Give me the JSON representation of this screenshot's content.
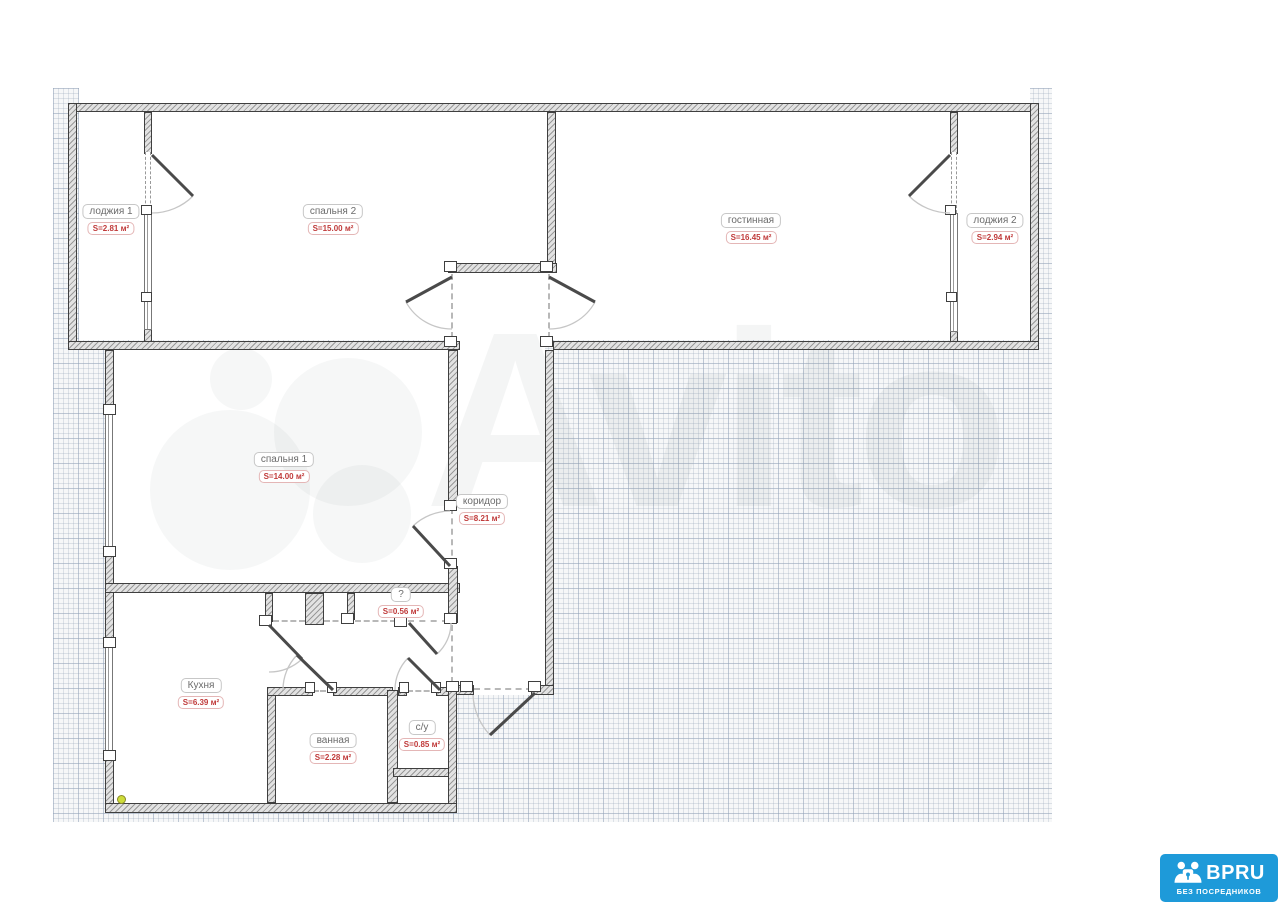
{
  "watermark_text": "Avito",
  "rooms": [
    {
      "name": "лоджия 1",
      "area": "S=2.81 м²"
    },
    {
      "name": "спальня 2",
      "area": "S=15.00 м²"
    },
    {
      "name": "гостинная",
      "area": "S=16.45 м²"
    },
    {
      "name": "лоджия 2",
      "area": "S=2.94 м²"
    },
    {
      "name": "спальня 1",
      "area": "S=14.00 м²"
    },
    {
      "name": "коридор",
      "area": "S=8.21 м²"
    },
    {
      "name": "?",
      "area": "S=0.56 м²"
    },
    {
      "name": "Кухня",
      "area": "S=6.39 м²"
    },
    {
      "name": "ванная",
      "area": "S=2.28 м²"
    },
    {
      "name": "с/у",
      "area": "S=0.85 м²"
    }
  ],
  "logo": {
    "brand": "BPRU",
    "tagline": "БЕЗ ПОСРЕДНИКОВ",
    "color": "#1e9ad9"
  },
  "colors": {
    "area_red": "#c03a3a",
    "label_gray": "#6b6b6b",
    "logo_blue": "#1e9ad9"
  }
}
